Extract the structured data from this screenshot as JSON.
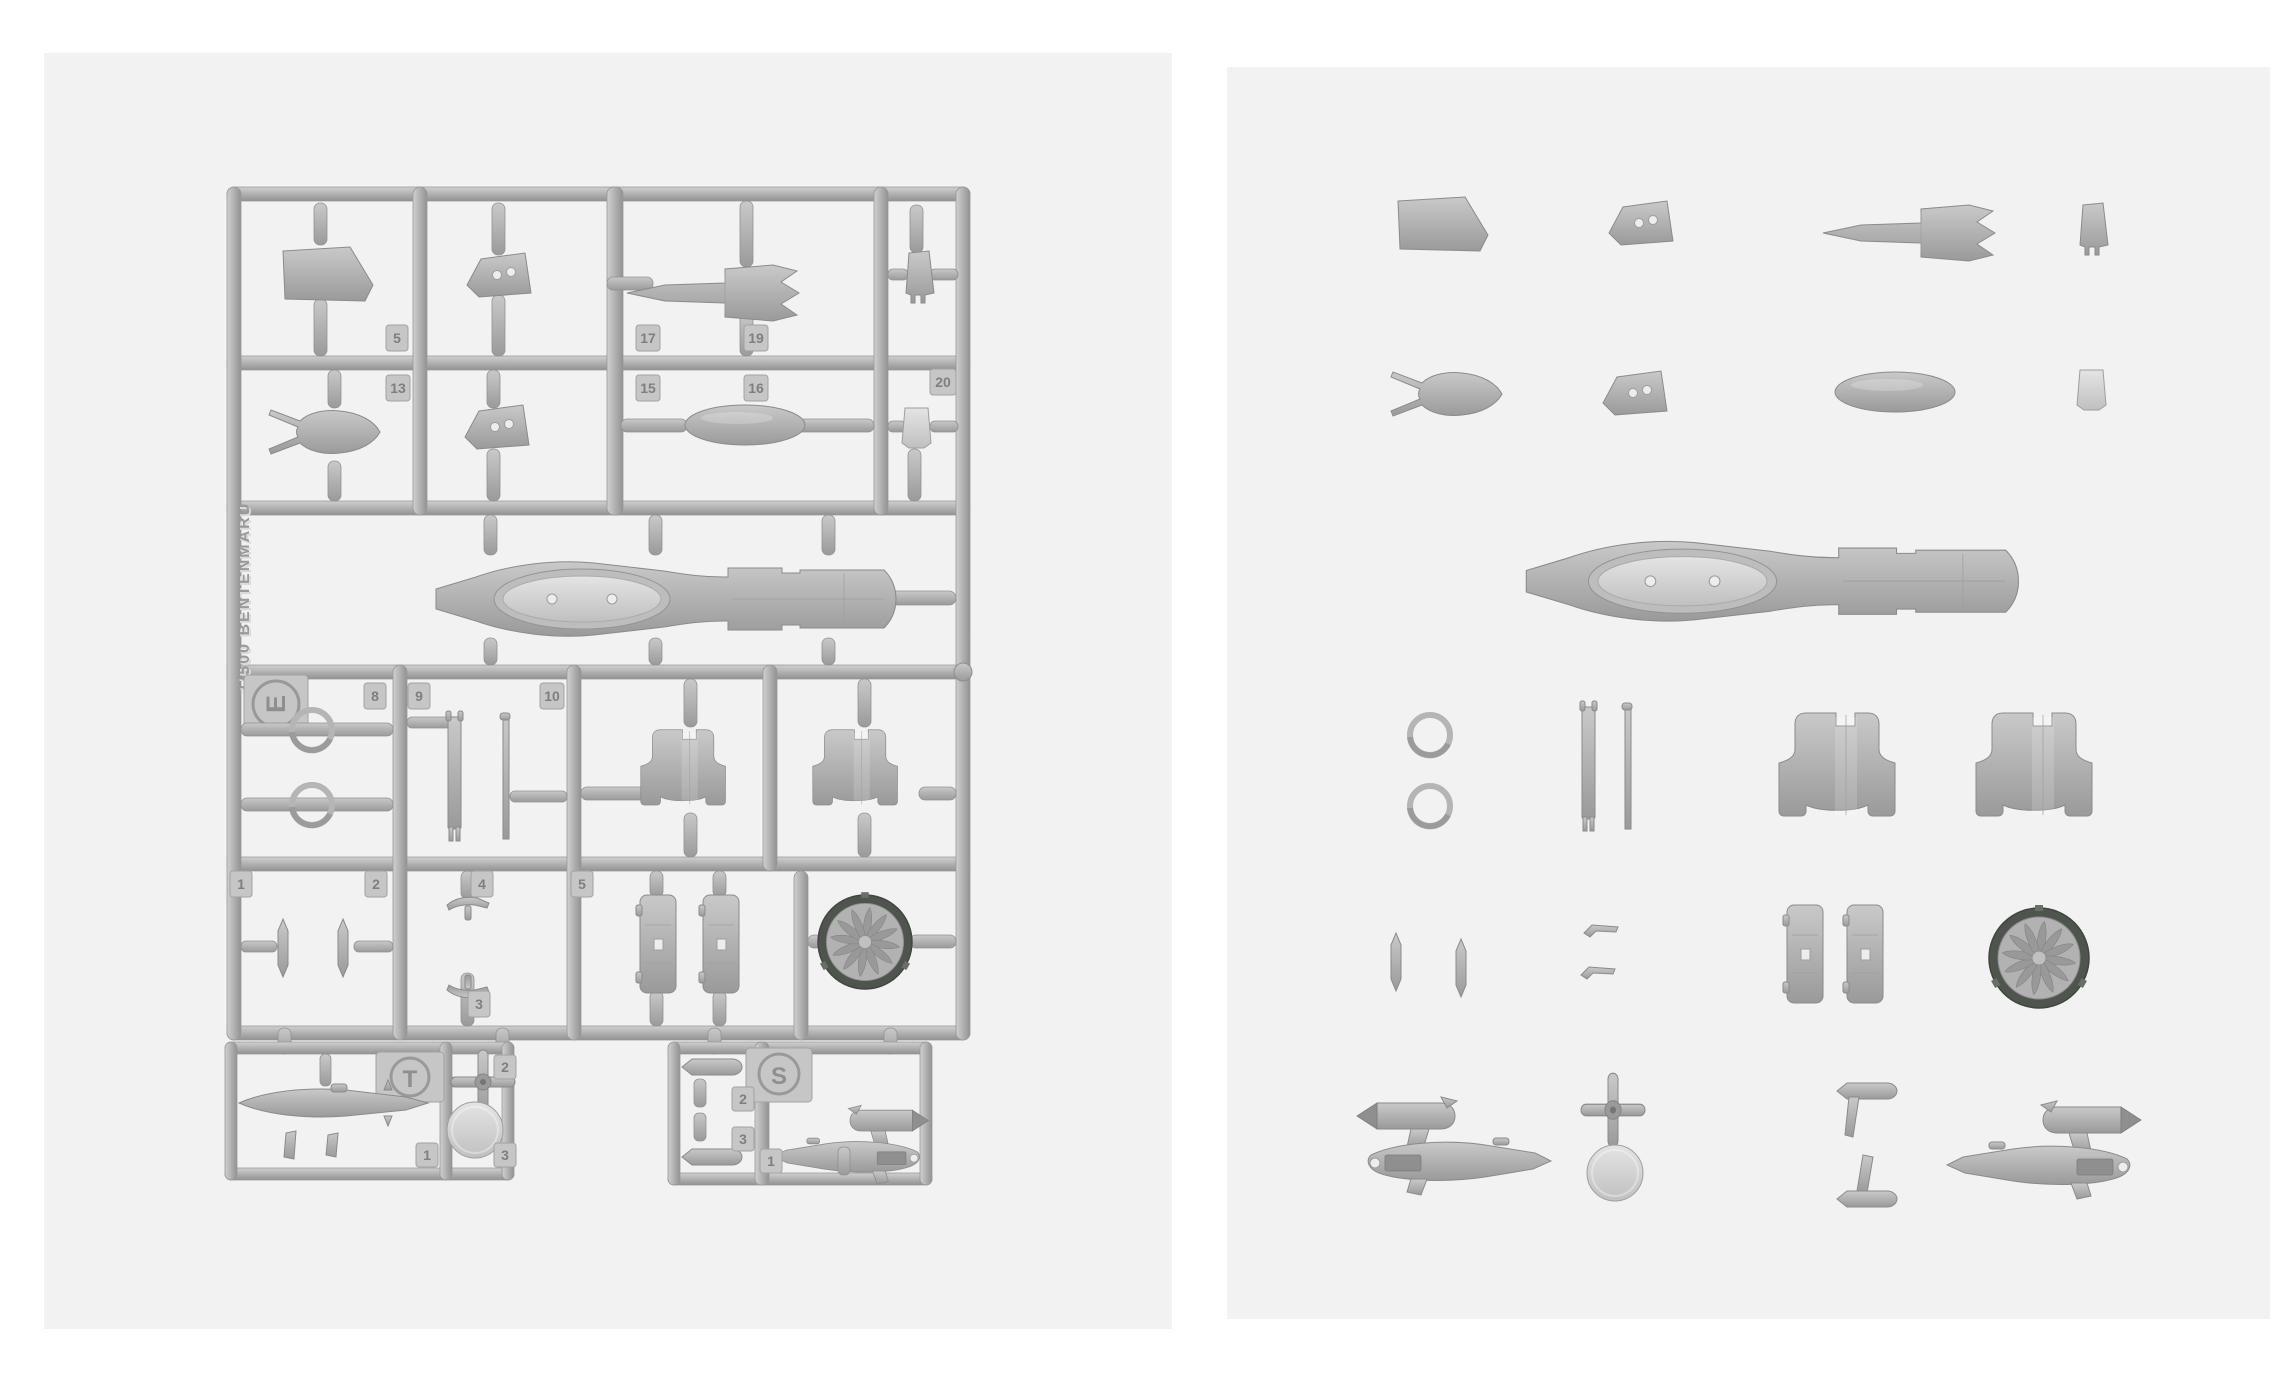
{
  "page": {
    "background": "#ffffff"
  },
  "colors": {
    "panel_background": "#f2f2f2",
    "plastic_base": "#a9a9a9",
    "plastic_highlight": "#c9c9c9",
    "plastic_shadow": "#8b8b8b",
    "fan_rim_dark": "#50544f"
  },
  "left_panel": {
    "description": "injection-molded sprue (runner) with parts attached"
  },
  "right_panel": {
    "description": "same kit parts laid out individually off the runner"
  },
  "sprue": {
    "brand_text": "1/500 BENTENMARU",
    "runner_letter": "E",
    "tab_labels": {
      "a5": "5",
      "a13": "13",
      "a17": "17",
      "a15": "15",
      "a19": "19",
      "a16": "16",
      "a20": "20",
      "a8": "8",
      "a9": "9",
      "a10": "10",
      "b1": "1",
      "b2": "2",
      "b4": "4",
      "b5": "5",
      "b3": "3"
    },
    "t_sprue": {
      "letter": "T",
      "tab_top": "2",
      "tab_left": "1",
      "tab_right": "3"
    },
    "s_sprue": {
      "letter": "S",
      "tab_a": "2",
      "tab_b": "3",
      "tab_c": "1"
    }
  },
  "parts_inventory": [
    "trapezoid-plate",
    "wedge-with-holes",
    "crown-spike",
    "small-wedge",
    "forked-bow",
    "wedge-with-holes-2",
    "ellipsoid-pod",
    "small-cup",
    "main-hull",
    "ring x2",
    "mast-strips",
    "engine-housing x2",
    "blade-fin x2",
    "t-antenna x2",
    "clamp-band x2",
    "fan-exhaust-disc",
    "small-ship x2",
    "cross-antenna",
    "round-disc",
    "torpedo-pod x2",
    "slim-hull"
  ]
}
